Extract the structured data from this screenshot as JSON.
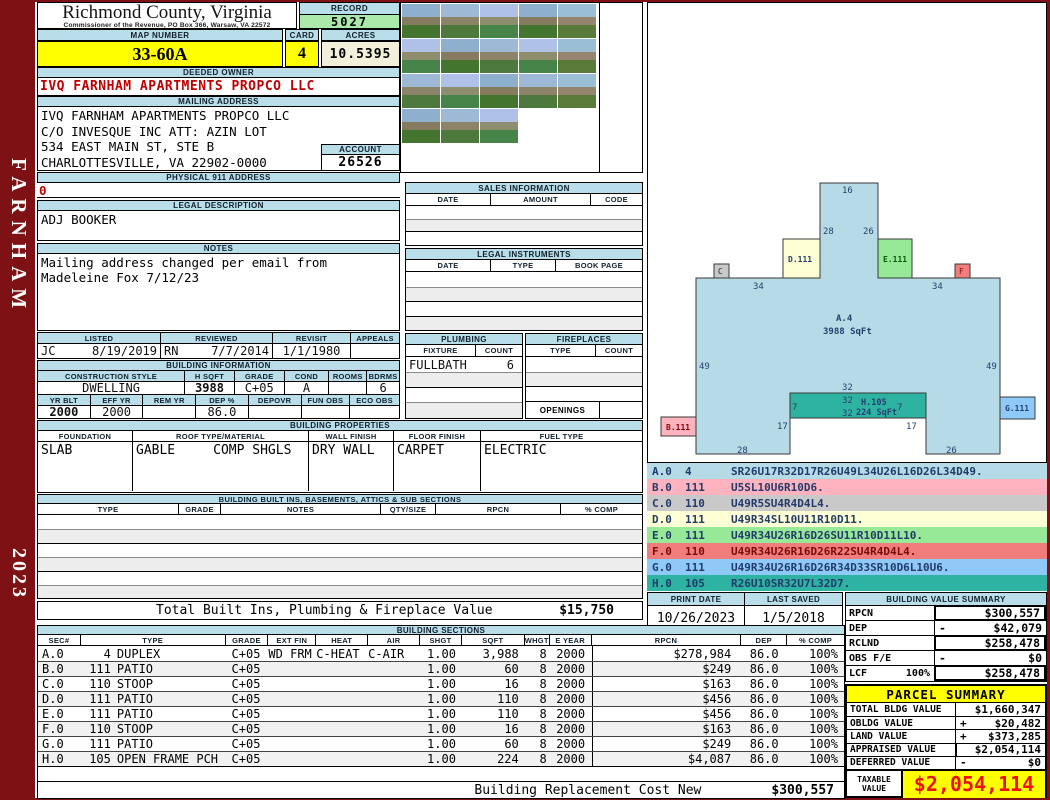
{
  "sidebar": {
    "name": "FARNHAM",
    "year": "2023"
  },
  "header": {
    "title": "Richmond County, Virginia",
    "subtitle": "Commissioner of the Revenue, PO Box 366, Warsaw, VA 22572"
  },
  "record": {
    "label": "RECORD",
    "value": "5027"
  },
  "map_number": {
    "label": "MAP NUMBER",
    "value": "33-60A"
  },
  "card": {
    "label": "CARD",
    "value": "4"
  },
  "acres": {
    "label": "ACRES",
    "value": "10.5395"
  },
  "deeded_owner": {
    "label": "DEEDED OWNER",
    "value": "IVQ FARNHAM APARTMENTS PROPCO LLC"
  },
  "mailing": {
    "label": "MAILING ADDRESS",
    "line1": "IVQ FARNHAM APARTMENTS PROPCO LLC",
    "line2": "C/O INVESQUE INC ATT: AZIN LOT",
    "line3": "534 EAST MAIN ST, STE B",
    "line4": "CHARLOTTESVILLE, VA 22902-0000"
  },
  "account": {
    "label": "ACCOUNT",
    "value": "26526"
  },
  "physical": {
    "label": "PHYSICAL 911 ADDRESS",
    "value": "0"
  },
  "legal_desc": {
    "label": "LEGAL DESCRIPTION",
    "value": "ADJ BOOKER"
  },
  "notes": {
    "label": "NOTES",
    "text": "Mailing address changed per email from Madeleine Fox 7/12/23"
  },
  "visits": {
    "h_listed": "LISTED",
    "h_reviewed": "REVIEWED",
    "h_revisit": "REVISIT",
    "h_appeals": "APPEALS",
    "listed_by": "JC",
    "listed_date": "8/19/2019",
    "reviewed_by": "RN",
    "reviewed_date": "7/7/2014",
    "revisit_date": "1/1/1980",
    "appeals": ""
  },
  "building_info": {
    "title": "BUILDING INFORMATION",
    "h_style": "CONSTRUCTION STYLE",
    "h_hsqft": "H SQFT",
    "h_grade": "GRADE",
    "h_cond": "COND",
    "h_rooms": "ROOMS",
    "h_bdrms": "BDRMS",
    "style": "DWELLING",
    "hsqft": "3988",
    "grade": "C+05",
    "cond": "A",
    "rooms": "",
    "bdrms": "6",
    "h_yrblt": "YR BLT",
    "h_effyr": "EFF YR",
    "h_remyr": "REM YR",
    "h_dep": "DEP %",
    "h_depovr": "DEPOVR",
    "h_funobs": "FUN OBS",
    "h_ecoobs": "ECO OBS",
    "yrblt": "2000",
    "effyr": "2000",
    "remyr": "",
    "dep": "86.0",
    "depovr": "",
    "funobs": "",
    "ecoobs": ""
  },
  "properties": {
    "title": "BUILDING PROPERTIES",
    "h_foundation": "FOUNDATION",
    "h_roof": "ROOF TYPE/MATERIAL",
    "h_wall": "WALL FINISH",
    "h_floor": "FLOOR FINISH",
    "h_fuel": "FUEL TYPE",
    "foundation": "SLAB",
    "roof_type": "GABLE",
    "roof_material": "COMP SHGLS",
    "wall": "DRY WALL",
    "floor": "CARPET",
    "fuel": "ELECTRIC"
  },
  "builtins": {
    "title": "BUILDING BUILT INS, BASEMENTS, ATTICS & SUB SECTIONS",
    "h_type": "TYPE",
    "h_grade": "GRADE",
    "h_notes": "NOTES",
    "h_qty": "QTY/SIZE",
    "h_rpcn": "RPCN",
    "h_comp": "% COMP",
    "total_label": "Total Built Ins, Plumbing & Fireplace Value",
    "total_value": "$15,750"
  },
  "sales": {
    "title": "SALES INFORMATION",
    "h_date": "DATE",
    "h_amount": "AMOUNT",
    "h_code": "CODE"
  },
  "instruments": {
    "title": "LEGAL INSTRUMENTS",
    "h_date": "DATE",
    "h_type": "TYPE",
    "h_book": "BOOK PAGE"
  },
  "plumbing": {
    "title": "PLUMBING",
    "h_fixture": "FIXTURE",
    "h_count": "COUNT",
    "fixture1": "FULLBATH",
    "count1": "6"
  },
  "fireplaces": {
    "title": "FIREPLACES",
    "h_type": "TYPE",
    "h_count": "COUNT",
    "openings_label": "OPENINGS"
  },
  "sketch": {
    "main_label": "A.4",
    "main_sqft": "3988 SqFt",
    "h_label": "H.105",
    "h_sqft": "224 SqFt",
    "att_b": "B.111",
    "att_c": "C",
    "att_d": "D.111",
    "att_e": "E.111",
    "att_f": "F",
    "att_g": "G.111",
    "dims": {
      "top": "16",
      "tower_l": "28",
      "tower_r": "26",
      "shoulder_l": "34",
      "shoulder_r": "34",
      "side_l": "49",
      "side_r": "49",
      "w32a": "32",
      "w32b": "32",
      "w32c": "32",
      "h7l": "7",
      "h7r": "7",
      "n17l": "17",
      "n17r": "17",
      "bot_l": "28",
      "bot_r": "26"
    }
  },
  "codes": {
    "rows": [
      {
        "sec": "A.0",
        "code": "4",
        "vec": "SR26U17R32D17R26U49L34U26L16D26L34D49."
      },
      {
        "sec": "B.0",
        "code": "111",
        "vec": "U5SL10U6R10D6."
      },
      {
        "sec": "C.0",
        "code": "110",
        "vec": "U49R5SU4R4D4L4."
      },
      {
        "sec": "D.0",
        "code": "111",
        "vec": "U49R34SL10U11R10D11."
      },
      {
        "sec": "E.0",
        "code": "111",
        "vec": "U49R34U26R16D26SU11R10D11L10."
      },
      {
        "sec": "F.0",
        "code": "110",
        "vec": "U49R34U26R16D26R22SU4R4D4L4."
      },
      {
        "sec": "G.0",
        "code": "111",
        "vec": "U49R34U26R16D26R34D33SR10D6L10U6."
      },
      {
        "sec": "H.0",
        "code": "105",
        "vec": "R26U10SR32U7L32D7."
      }
    ]
  },
  "print_info": {
    "h_print": "PRINT DATE",
    "print_date": "10/26/2023",
    "h_saved": "LAST SAVED",
    "last_saved": "1/5/2018"
  },
  "bvs": {
    "title": "BUILDING VALUE SUMMARY",
    "r1_label": "RPCN",
    "r1_op": "",
    "r1_value": "$300,557",
    "r2_label": "DEP",
    "r2_op": "-",
    "r2_value": "$42,079",
    "r3_label": "RCLND",
    "r3_op": "",
    "r3_value": "$258,478",
    "r4_label": "OBS F/E",
    "r4_op": "-",
    "r4_value": "$0",
    "r5_label": "LCF",
    "r5_pct": "100%",
    "r5_op": "",
    "r5_value": "$258,478"
  },
  "sections": {
    "title": "BUILDING SECTIONS",
    "headers": [
      "SEC#",
      "TYPE",
      "GRADE",
      "EXT FIN",
      "HEAT",
      "AIR",
      "SHGT",
      "SQFT",
      "WHGT",
      "E YEAR",
      "RPCN",
      "DEP",
      "% COMP"
    ],
    "rows": [
      {
        "sec": "A.0",
        "code": "4",
        "name": "DUPLEX",
        "grade": "C+05",
        "extfin": "WD FRM",
        "heat": "C-HEAT",
        "air": "C-AIR",
        "shgt": "1.00",
        "sqft": "3,988",
        "whgt": "8",
        "eyear": "2000",
        "rpcn": "$278,984",
        "dep": "86.0",
        "comp": "100%"
      },
      {
        "sec": "B.0",
        "code": "111",
        "name": "PATIO",
        "grade": "C+05",
        "extfin": "",
        "heat": "",
        "air": "",
        "shgt": "1.00",
        "sqft": "60",
        "whgt": "8",
        "eyear": "2000",
        "rpcn": "$249",
        "dep": "86.0",
        "comp": "100%"
      },
      {
        "sec": "C.0",
        "code": "110",
        "name": "STOOP",
        "grade": "C+05",
        "extfin": "",
        "heat": "",
        "air": "",
        "shgt": "1.00",
        "sqft": "16",
        "whgt": "8",
        "eyear": "2000",
        "rpcn": "$163",
        "dep": "86.0",
        "comp": "100%"
      },
      {
        "sec": "D.0",
        "code": "111",
        "name": "PATIO",
        "grade": "C+05",
        "extfin": "",
        "heat": "",
        "air": "",
        "shgt": "1.00",
        "sqft": "110",
        "whgt": "8",
        "eyear": "2000",
        "rpcn": "$456",
        "dep": "86.0",
        "comp": "100%"
      },
      {
        "sec": "E.0",
        "code": "111",
        "name": "PATIO",
        "grade": "C+05",
        "extfin": "",
        "heat": "",
        "air": "",
        "shgt": "1.00",
        "sqft": "110",
        "whgt": "8",
        "eyear": "2000",
        "rpcn": "$456",
        "dep": "86.0",
        "comp": "100%"
      },
      {
        "sec": "F.0",
        "code": "110",
        "name": "STOOP",
        "grade": "C+05",
        "extfin": "",
        "heat": "",
        "air": "",
        "shgt": "1.00",
        "sqft": "16",
        "whgt": "8",
        "eyear": "2000",
        "rpcn": "$163",
        "dep": "86.0",
        "comp": "100%"
      },
      {
        "sec": "G.0",
        "code": "111",
        "name": "PATIO",
        "grade": "C+05",
        "extfin": "",
        "heat": "",
        "air": "",
        "shgt": "1.00",
        "sqft": "60",
        "whgt": "8",
        "eyear": "2000",
        "rpcn": "$249",
        "dep": "86.0",
        "comp": "100%"
      },
      {
        "sec": "H.0",
        "code": "105",
        "name": "OPEN FRAME PCH",
        "grade": "C+05",
        "extfin": "",
        "heat": "",
        "air": "",
        "shgt": "1.00",
        "sqft": "224",
        "whgt": "8",
        "eyear": "2000",
        "rpcn": "$4,087",
        "dep": "86.0",
        "comp": "100%"
      }
    ],
    "repl_label": "Building Replacement Cost New",
    "repl_value": "$300,557"
  },
  "parcel": {
    "title": "PARCEL SUMMARY",
    "r1_label": "TOTAL BLDG VALUE",
    "r1_op": "",
    "r1_value": "$1,660,347",
    "r2_label": "OBLDG VALUE",
    "r2_op": "+",
    "r2_value": "$20,482",
    "r3_label": "LAND VALUE",
    "r3_op": "+",
    "r3_value": "$373,285",
    "r4_label": "APPRAISED VALUE",
    "r4_op": "",
    "r4_value": "$2,054,114",
    "r5_label": "DEFERRED VALUE",
    "r5_op": "-",
    "r5_value": "$0",
    "taxable_label1": "TAXABLE",
    "taxable_label2": "VALUE",
    "taxable_value": "$2,054,114"
  },
  "colors": {
    "frame": "#7E1113",
    "bar_blue": "#B9DDE9",
    "highlight_yellow": "#FFFF00",
    "record_green": "#ABE9AB",
    "acres_beige": "#F2F0DB",
    "red_text": "#C00000",
    "taxable_red": "#EE1111",
    "sketch_teal": "#2EB3A3"
  }
}
